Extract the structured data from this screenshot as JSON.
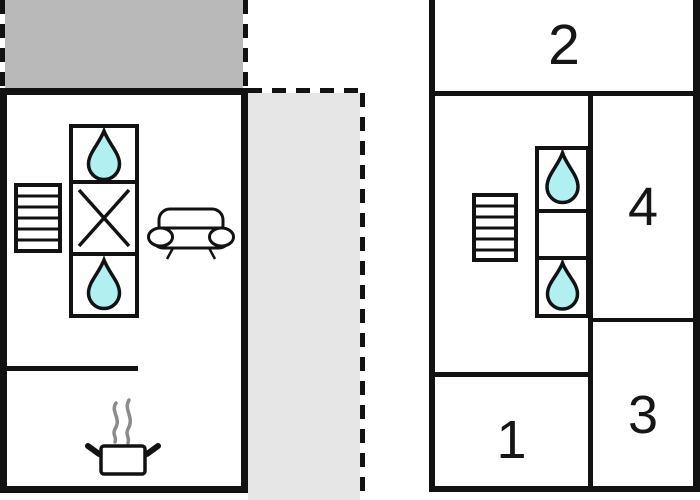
{
  "title": "two-unit floor plan",
  "colors": {
    "wall": "#121212",
    "dark_terrace": "#b9b9b9",
    "light_terrace": "#e6e6e6",
    "water_drop_fill": "#b0f0f0",
    "steam": "#8c8c8c",
    "background": "#ffffff",
    "label_text": "#161616"
  },
  "left_plan": {
    "name": "left-unit-floor-plan",
    "areas": [
      {
        "name": "upper-terrace-area",
        "fill": "#b9b9b9",
        "border_style": "dashed"
      },
      {
        "name": "main-room",
        "fill": "#ffffff",
        "border_style": "solid"
      },
      {
        "name": "side-terrace-area",
        "fill": "#e6e6e6",
        "border_style": "dashed"
      }
    ],
    "icons": [
      "stairs-icon",
      "water-drop-icon",
      "crossed-square-icon",
      "water-drop-icon",
      "sofa-icon",
      "cooking-pot-icon",
      "steam-icon"
    ]
  },
  "right_plan": {
    "name": "right-unit-floor-plan",
    "rooms": [
      {
        "label": "2"
      },
      {
        "label": "4"
      },
      {
        "label": "3"
      },
      {
        "label": "1"
      }
    ],
    "icons": [
      "stairs-icon",
      "water-drop-icon",
      "water-drop-icon"
    ]
  }
}
